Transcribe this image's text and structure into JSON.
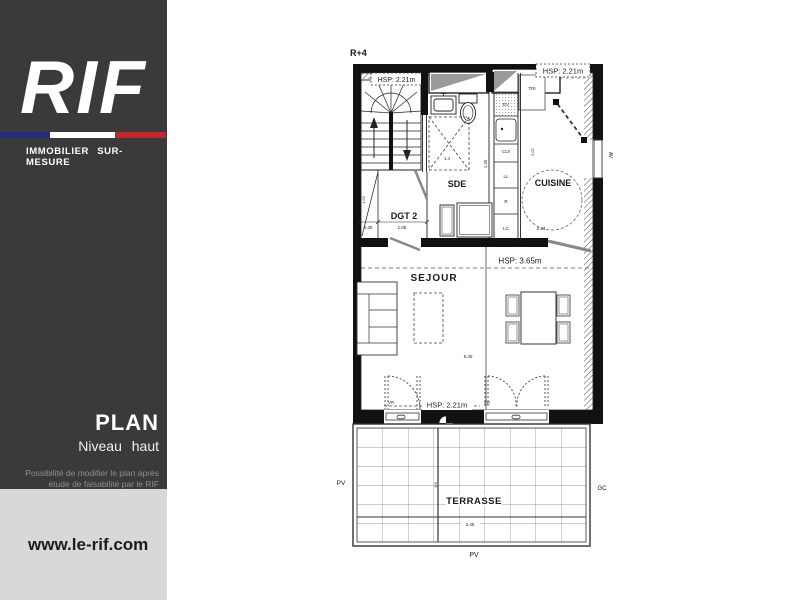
{
  "sidebar": {
    "logo_text": "RIF",
    "logo_tagline": "IMMOBILIER SUR-MESURE",
    "flag_colors": {
      "blue": "#272c7e",
      "white": "#ffffff",
      "red": "#c1272d"
    },
    "background": "#3a3a3c",
    "title": "PLAN",
    "subtitle": "Niveau haut",
    "note_line1": "Possibilité de modifier le plan après",
    "note_line2": "étude de faisabilité par le RIF",
    "footer": {
      "background": "#d8d8d8",
      "website": "www.le-rif.com"
    }
  },
  "plan": {
    "level": "R+4",
    "rooms": {
      "sde": "SDE",
      "dgt": "DGT 2",
      "cuisine": "CUISINE",
      "sejour": "SEJOUR",
      "terrasse": "TERRASSE"
    },
    "heights": {
      "stairs": "HSP: 2.21m",
      "kitchen": "HSP: 2.21m",
      "sejour": "HSP: 3.65m",
      "bay": "HSP: 2.21m"
    },
    "equipment": {
      "tri": "TRI",
      "ev": "EV",
      "cui": "CUI",
      "ll": "LL",
      "r": "R",
      "lc": "LC"
    },
    "openings": {
      "vr_left": "VR",
      "vr_right": "VR",
      "av": "AV",
      "pv_left": "PV",
      "pv_bottom": "PV",
      "gc": "GC"
    },
    "dimensions": {
      "closet_width": "0.40",
      "dgt_width": "1.05",
      "sde_width": "1.35",
      "shower": "1.4",
      "closet_height": "1.52",
      "kitchen_depth": "2.07",
      "kitchen_width": "2.24",
      "sejour_width": "5.40",
      "terrace_width": "3.45",
      "terrace_depth": "3.6"
    }
  }
}
